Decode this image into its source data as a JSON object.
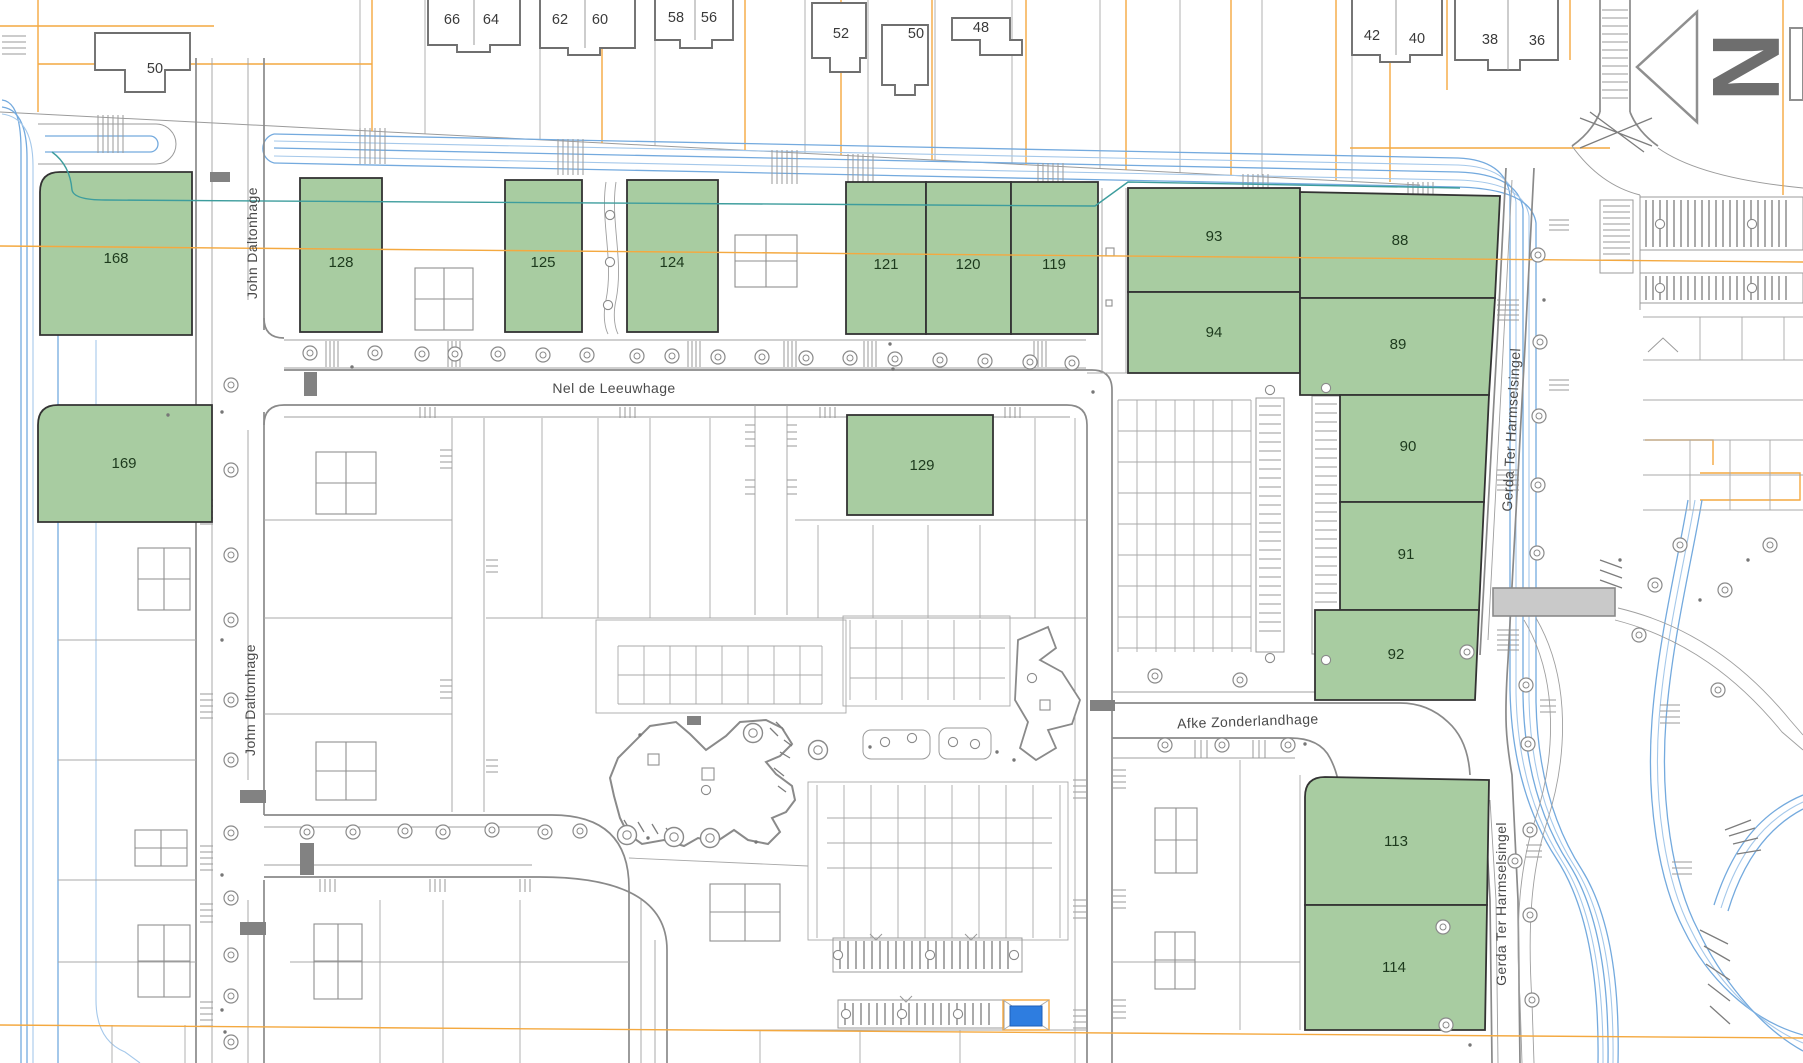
{
  "map": {
    "type": "cadastral-plot-map",
    "green_parcels": [
      {
        "number": "168"
      },
      {
        "number": "128"
      },
      {
        "number": "125"
      },
      {
        "number": "124"
      },
      {
        "number": "121"
      },
      {
        "number": "120"
      },
      {
        "number": "119"
      },
      {
        "number": "93"
      },
      {
        "number": "94"
      },
      {
        "number": "88"
      },
      {
        "number": "89"
      },
      {
        "number": "90"
      },
      {
        "number": "91"
      },
      {
        "number": "92"
      },
      {
        "number": "129"
      },
      {
        "number": "169"
      },
      {
        "number": "113"
      },
      {
        "number": "114"
      }
    ],
    "houses": [
      {
        "number": "50"
      },
      {
        "number": "66"
      },
      {
        "number": "64"
      },
      {
        "number": "62"
      },
      {
        "number": "60"
      },
      {
        "number": "58"
      },
      {
        "number": "56"
      },
      {
        "number": "52"
      },
      {
        "number": "50"
      },
      {
        "number": "48"
      },
      {
        "number": "42"
      },
      {
        "number": "40"
      },
      {
        "number": "38"
      },
      {
        "number": "36"
      }
    ],
    "streets": {
      "john_daltonhage": "John Daltonhage",
      "nel_de_leeuwhage": "Nel de Leeuwhage",
      "afke_zonderlandhage": "Afke Zonderlandhage",
      "gerda_ter_harmselsingel": "Gerda Ter Harmselsingel"
    },
    "north_arrow": {
      "label": "N"
    },
    "colors": {
      "parcel_fill": "#a8cca1",
      "parcel_border": "#333333",
      "water_blue": "#74aade",
      "boundary_orange": "#f4a940",
      "road_gray": "#8a8a8a",
      "watercourse_teal": "#3d9d9d",
      "bridge_gray": "#c9c9c9",
      "utility_blue": "#2e7de0"
    }
  }
}
